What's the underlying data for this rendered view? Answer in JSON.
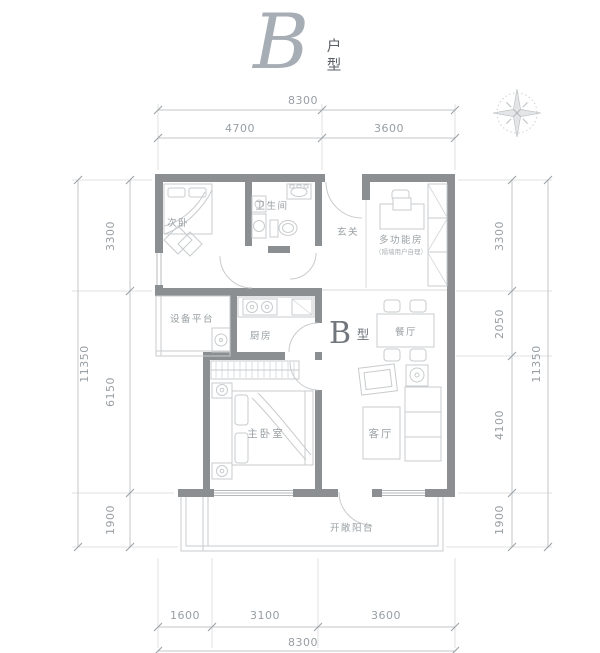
{
  "title": {
    "letter": "B",
    "label_top": "户",
    "label_bottom": "型"
  },
  "icons": {
    "compass": "compass-rose-icon"
  },
  "plan": {
    "type_label": {
      "letter": "B",
      "suffix": "型"
    },
    "rooms": {
      "secondary_bedroom": "次卧",
      "bathroom": "卫生间",
      "entry": "玄关",
      "multifunction": "多功能房",
      "multifunction_note": "（隔墙用户自理）",
      "equipment_platform": "设备平台",
      "kitchen": "厨房",
      "dining": "餐厅",
      "master_bedroom": "主卧室",
      "living_room": "客厅",
      "balcony": "开敞阳台"
    }
  },
  "dimensions": {
    "top": {
      "total": "8300",
      "segments": [
        "4700",
        "3600"
      ]
    },
    "bottom": {
      "total": "8300",
      "segments": [
        "1600",
        "3100",
        "3600"
      ]
    },
    "left": {
      "total": "11350",
      "segments": [
        "3300",
        "6150",
        "1900"
      ]
    },
    "right": {
      "total": "11350",
      "segments": [
        "3300",
        "2050",
        "4100",
        "1900"
      ]
    }
  }
}
